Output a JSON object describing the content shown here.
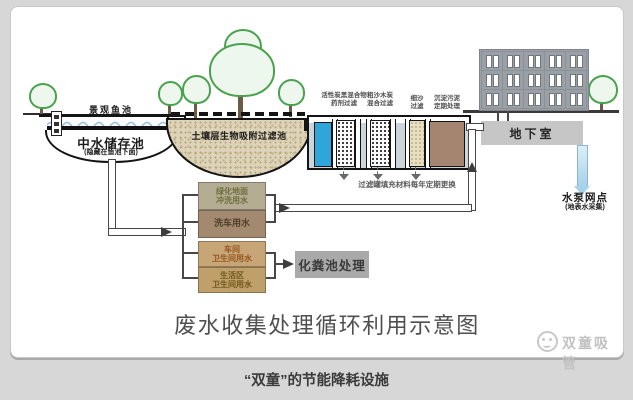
{
  "page": {
    "caption": "“双童”的节能降耗设施"
  },
  "diagram": {
    "title": "废水收集处理循环利用示意图",
    "watermark": "双童吸管",
    "pond": {
      "fish_pond_label": "景观鱼池",
      "storage_label": "中水储存池",
      "storage_note": "(隐藏在鱼池下面)"
    },
    "soil_filter": {
      "label": "土壤层生物吸附过滤池"
    },
    "filter_tank": {
      "stages": [
        {
          "line1": "活性炭黑混合物",
          "line2": "药剂过滤"
        },
        {
          "line1": "粗沙木炭",
          "line2": "混合过滤"
        },
        {
          "line1": "细沙",
          "line2": "过滤"
        },
        {
          "line1": "沉淀污泥",
          "line2": "定期处理"
        }
      ],
      "note": "过滤罐填充材料每年定期更换"
    },
    "building": {
      "basement_label": "地下室"
    },
    "pump": {
      "label": "水泵网点",
      "note": "(地表水采集)"
    },
    "usage_boxes": [
      {
        "line1": "绿化地面",
        "line2": "冲洗用水"
      },
      {
        "line1": "洗车用水",
        "line2": ""
      },
      {
        "line1": "车间",
        "line2": "卫生间用水"
      },
      {
        "line1": "生活区",
        "line2": "卫生间用水"
      }
    ],
    "septic": {
      "label": "化粪池处理"
    }
  },
  "colors": {
    "page_background": "#d7d7d7",
    "card_background": "#ffffff",
    "water_blue_column": "#2ea6d9",
    "tank_water": "#ccd6da",
    "sludge_brown": "#a58570",
    "soil_tan": "#ddd3b8",
    "building_gray": "#9aa0a5",
    "basement_gray": "#c6c6c6",
    "septic_gray": "#a9a9a9",
    "box_green_roof": "#b5ac94",
    "box_brown": "#a2896f",
    "box_tan1": "#c8a577",
    "box_tan2": "#bfa06b",
    "pipe_dark": "#474747",
    "tree_green": "#4aa24f"
  }
}
